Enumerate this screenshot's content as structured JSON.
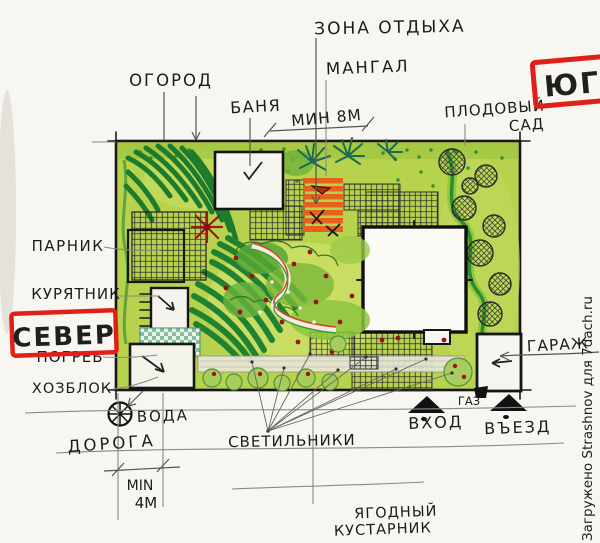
{
  "labels": {
    "zone_rest": "ЗОНА ОТДЫХА",
    "mangal": "МАНГАЛ",
    "ogorod": "ОГОРОД",
    "banya": "БАНЯ",
    "min_8m": "МИН 8М",
    "fruit_garden_line1": "ПЛОДОВЫЙ",
    "fruit_garden_line2": "САД",
    "parnik": "ПАРНИК",
    "kuryatnik": "КУРЯТНИК",
    "pogreb": "ПОГРЕБ",
    "hozblok": "ХОЗБЛОК",
    "voda": "ВОДА",
    "doroga": "ДОРОГА",
    "min_4m_line1": "MIN",
    "min_4m_line2": "4М",
    "svetilniki": "СВЕТИЛЬНИКИ",
    "vhod": "ВХОД",
    "gaz": "ГАЗ",
    "vyezd": "ВЪЕЗД",
    "berry_line1": "ЯГОДНЫЙ",
    "berry_line2": "КУСТАРНИК",
    "garage": "ГАРАЖ"
  },
  "stamps": {
    "north": "СЕВЕР",
    "south": "ЮГ"
  },
  "watermark": "Загружено Strashnov для 7dach.ru",
  "colors": {
    "stamp_red": "#e02018",
    "plan_green": "#b7d24d",
    "mangal_orange": "#e8611c",
    "bed_dark_green": "#1f8232",
    "ink": "#1a1a1a",
    "pencil": "#8a8a80",
    "watermark_gray": "#9b9b9b"
  }
}
